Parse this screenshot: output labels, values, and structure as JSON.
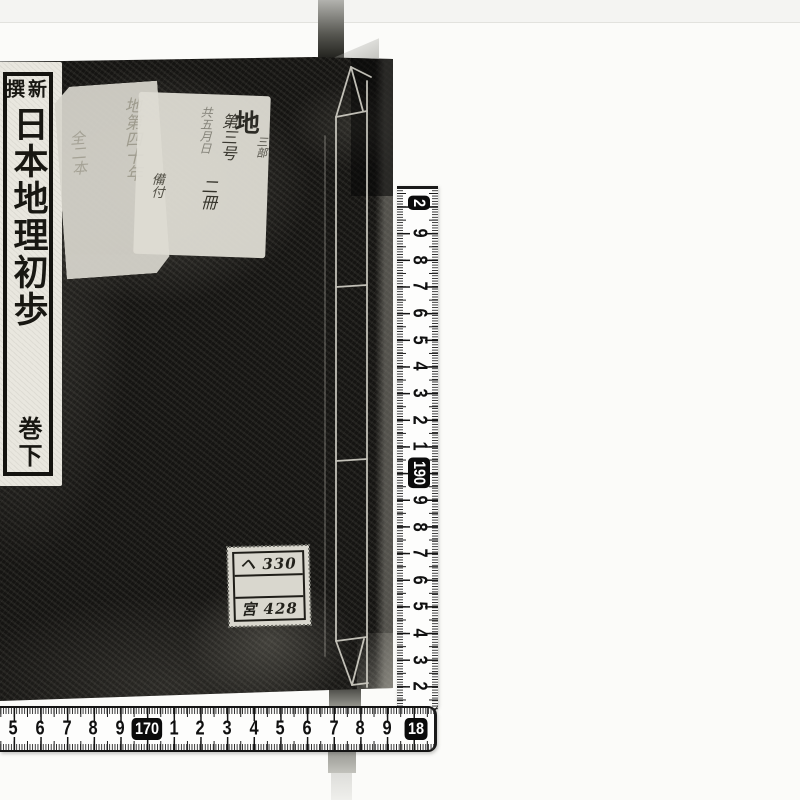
{
  "book": {
    "title_label": {
      "header_right_char": "新",
      "header_left_char": "撰",
      "main_title": "日本地理初歩",
      "volume": "巻下"
    },
    "handwritten_labels": {
      "left_faded": {
        "column_1": "地第四十年",
        "column_2": "全二本"
      },
      "right": {
        "large_char": "地",
        "small_sub": "三部",
        "column_number": "第三号",
        "column_faint": "共五月日",
        "column_volumes": "二冊",
        "column_note": "備付"
      }
    },
    "catalog_stamp": {
      "row_1": "ヘ 330",
      "row_2": "",
      "row_3": "宮 428"
    }
  },
  "rulers": {
    "horizontal": {
      "labels": [
        {
          "t": "5"
        },
        {
          "t": "6"
        },
        {
          "t": "7"
        },
        {
          "t": "8"
        },
        {
          "t": "9"
        },
        {
          "t": "170"
        },
        {
          "t": "1"
        },
        {
          "t": "2"
        },
        {
          "t": "3"
        },
        {
          "t": "4"
        },
        {
          "t": "5"
        },
        {
          "t": "6"
        },
        {
          "t": "7"
        },
        {
          "t": "8"
        },
        {
          "t": "9"
        },
        {
          "t": "18"
        }
      ]
    },
    "vertical": {
      "labels": [
        {
          "t": "2"
        },
        {
          "t": "9"
        },
        {
          "t": "8"
        },
        {
          "t": "7"
        },
        {
          "t": "6"
        },
        {
          "t": "5"
        },
        {
          "t": "4"
        },
        {
          "t": "3"
        },
        {
          "t": "2"
        },
        {
          "t": "1"
        },
        {
          "t": "190"
        },
        {
          "t": "9"
        },
        {
          "t": "8"
        },
        {
          "t": "7"
        },
        {
          "t": "6"
        },
        {
          "t": "5"
        },
        {
          "t": "4"
        },
        {
          "t": "3"
        },
        {
          "t": "2"
        }
      ]
    }
  },
  "colors": {
    "book_cover": "#151412",
    "label_paper": "#e9e7df",
    "ruler_tape": "#fdfdfc",
    "ruler_ink": "#101010",
    "ruler_box": "#0b0b0b",
    "background": "#fbfbf9"
  }
}
